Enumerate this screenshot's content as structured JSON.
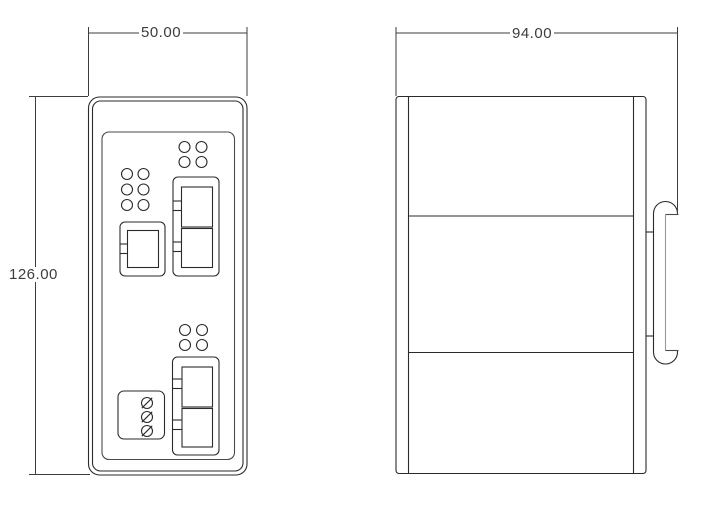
{
  "drawing": {
    "front_view": {
      "width_label": "50.00",
      "height_label": "126.00"
    },
    "side_view": {
      "width_label": "94.00"
    }
  },
  "colors": {
    "background": "#ffffff",
    "line": "#2a2a2a",
    "panel_line": "#4a4a4a",
    "clip_slot_line": "#999999",
    "dim_text": "#3d3d3d"
  }
}
